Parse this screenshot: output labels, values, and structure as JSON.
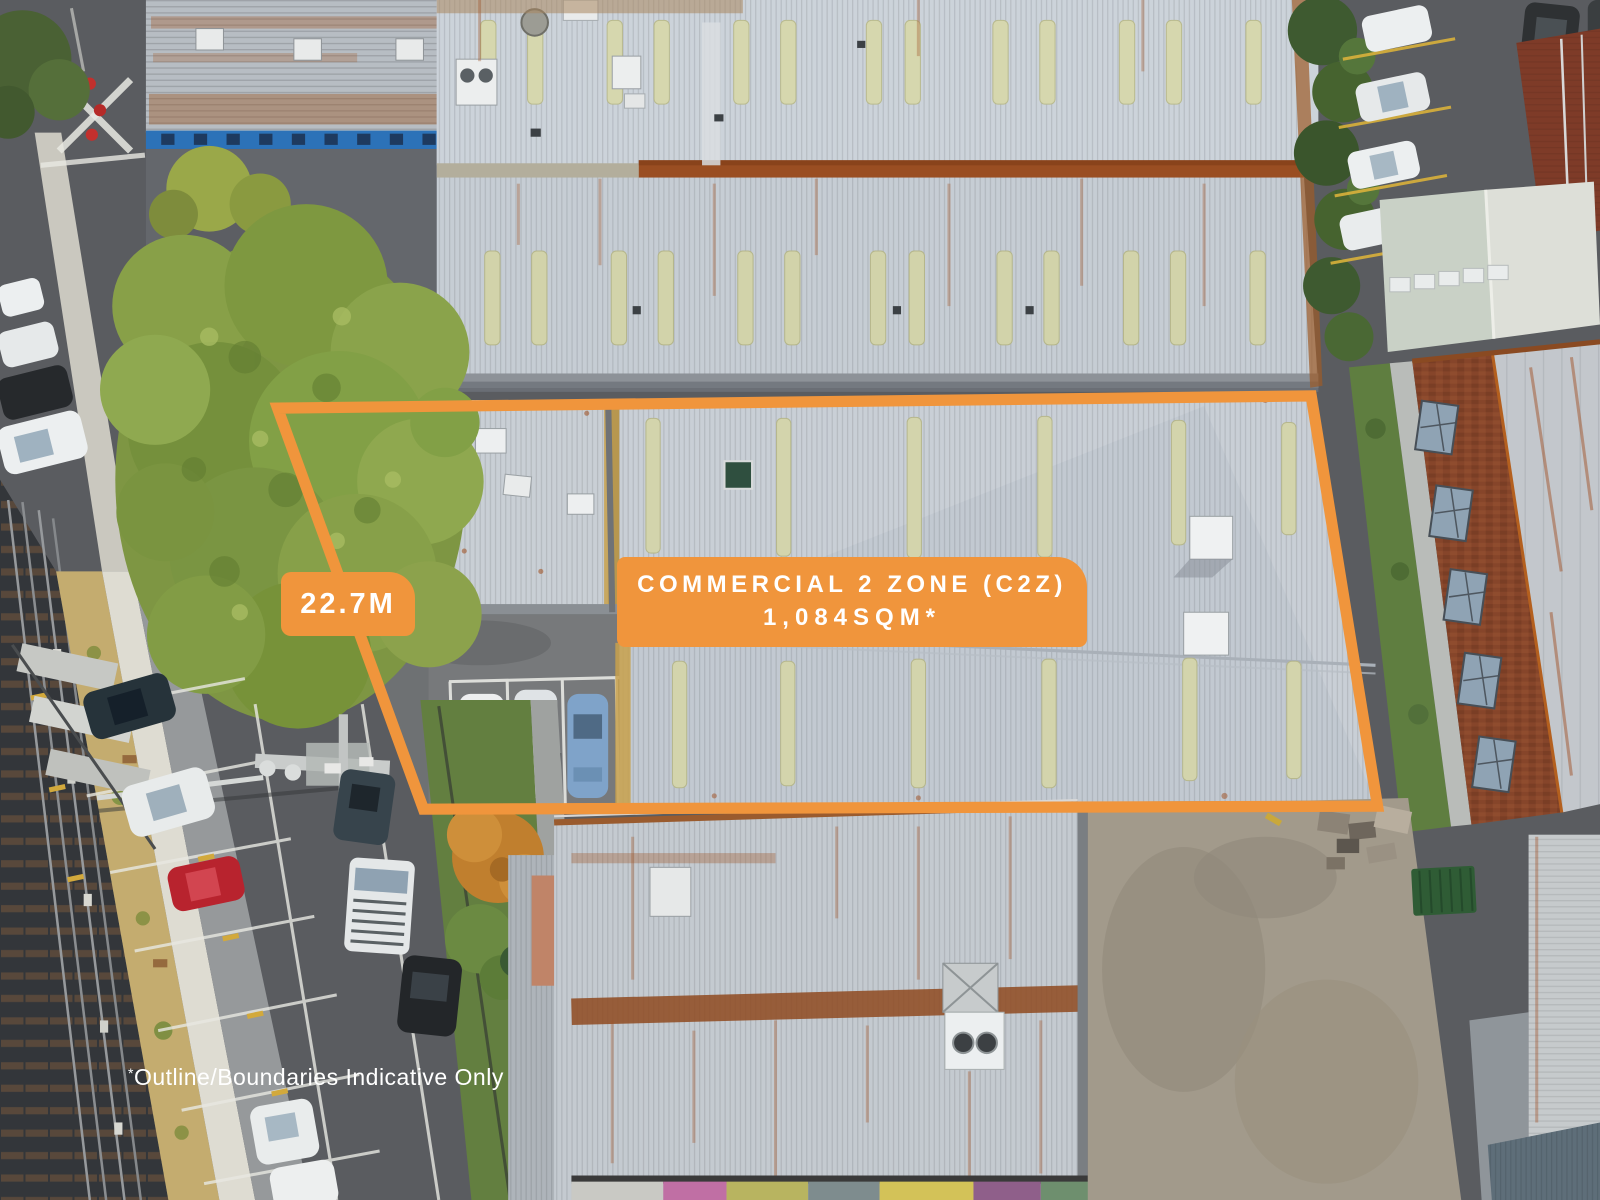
{
  "overlay": {
    "zone_label": {
      "line1": "COMMERCIAL 2 ZONE (C2Z)",
      "line2": "1,084SQM*"
    },
    "dimension_label": "22.7M",
    "disclaimer": {
      "asterisk": "*",
      "text": "Outline/Boundaries Indicative Only"
    },
    "colors": {
      "boundary_orange": "#F0953C",
      "label_text": "#FFFFFF"
    }
  }
}
